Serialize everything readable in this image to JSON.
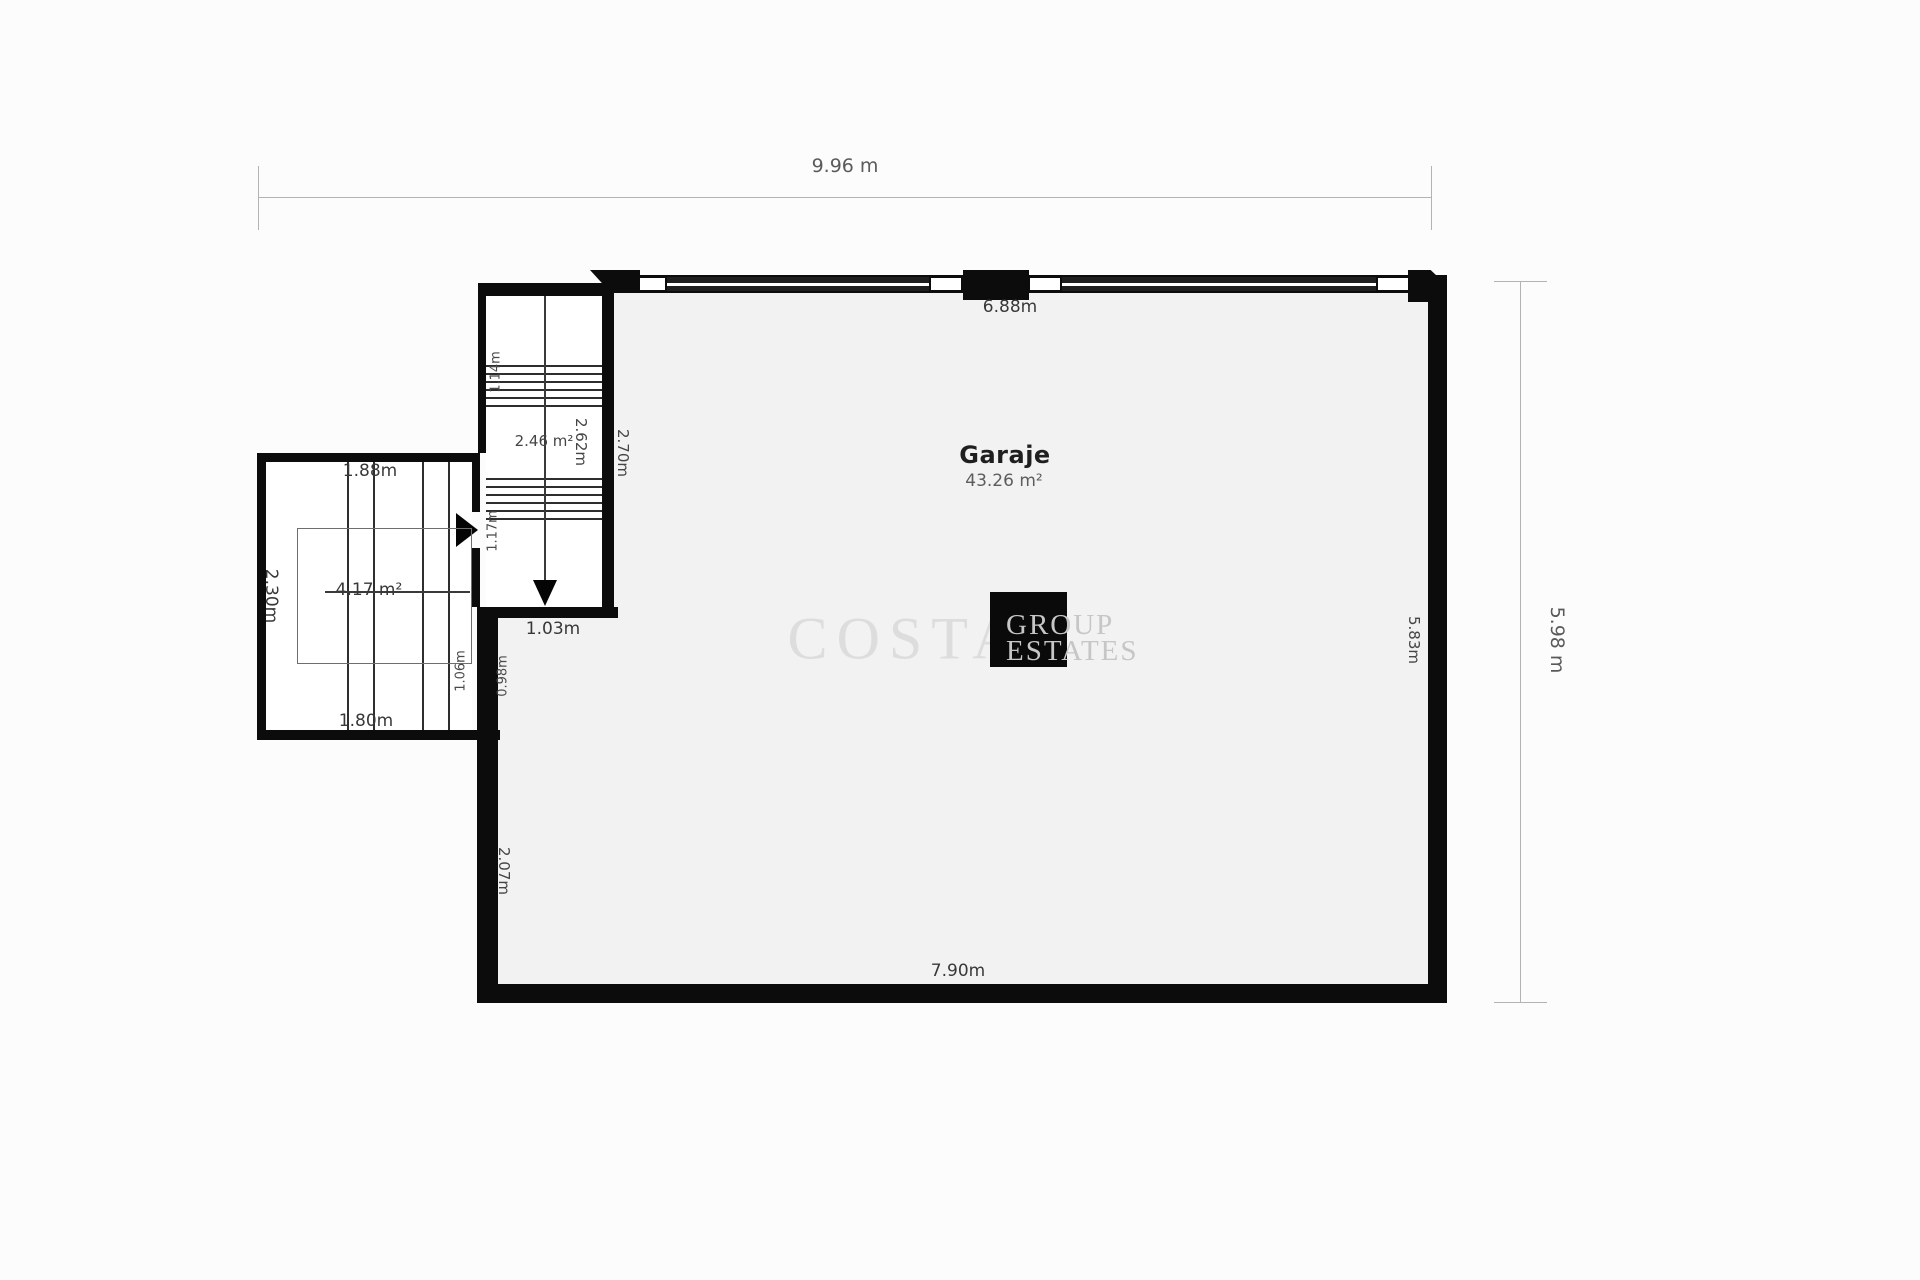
{
  "plan": {
    "overall": {
      "width_label": "9.96 m",
      "height_label": "5.98 m"
    },
    "garage": {
      "name": "Garaje",
      "area": "43.26 m²",
      "dim_top": "6.88m",
      "dim_right": "5.83m",
      "dim_bottom": "7.90m",
      "dim_left_lower": "2.07m"
    },
    "stairwell": {
      "area": "2.46 m²",
      "dim_inner": "2.62m",
      "dim_right": "2.70m",
      "dim_upper_flight": "1.14m",
      "dim_door": "1.17m",
      "dim_bottom": "1.03m"
    },
    "side_room": {
      "area": "4.17 m²",
      "dim_top": "1.88m",
      "dim_left": "2.30m",
      "dim_bottom": "1.80m",
      "dim_junction_left": "1.06m",
      "dim_junction_right": "0.98m"
    },
    "watermark": {
      "brand_word": "COSTA",
      "brand_line1": "GROUP",
      "brand_line2": "ESTATES"
    }
  }
}
